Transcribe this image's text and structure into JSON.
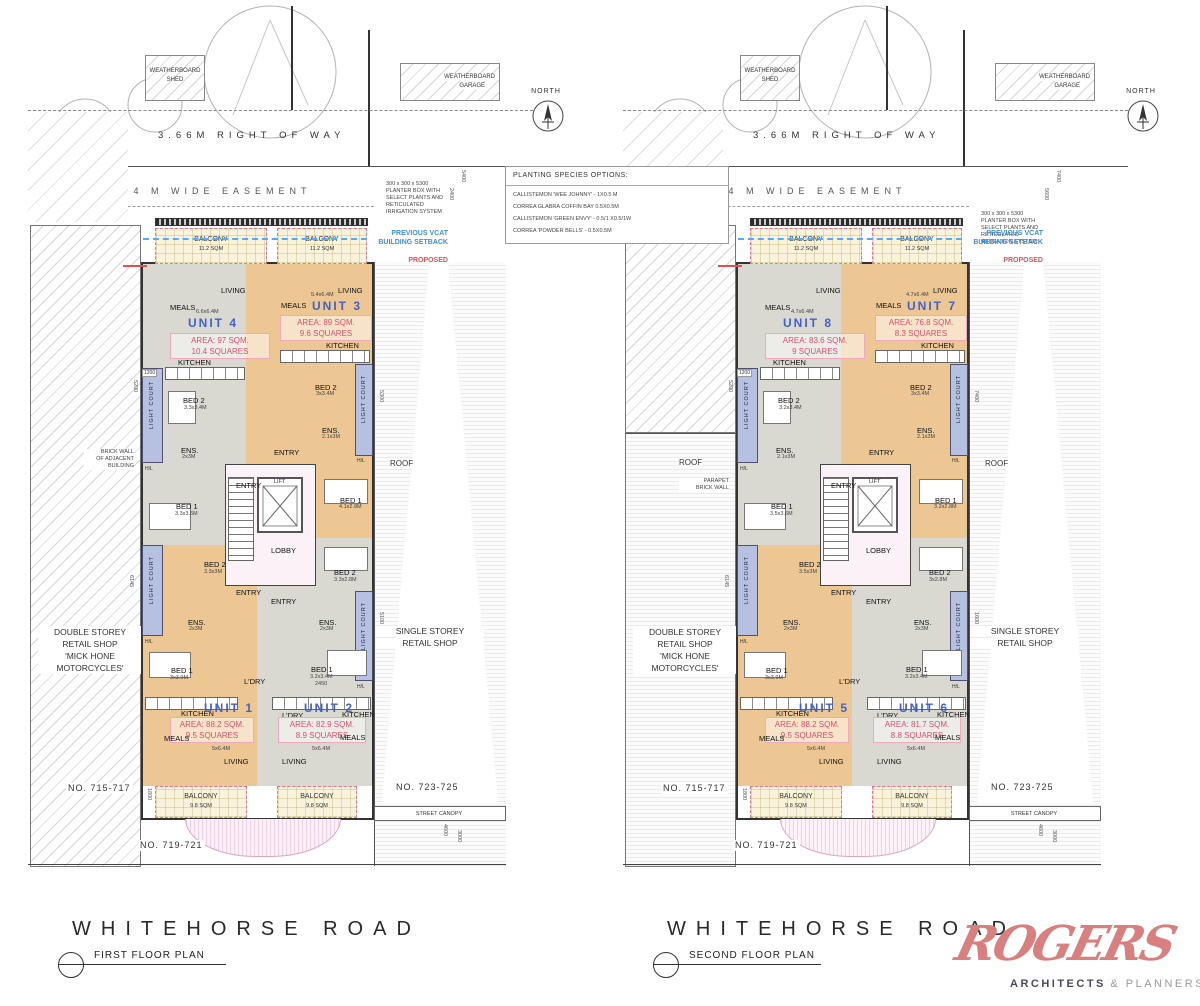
{
  "shared": {
    "shed_line1": "WEATHERBOARD",
    "shed_line2": "SHED",
    "garage_line1": "WEATHERBOARD",
    "garage_line2": "GARAGE",
    "right_of_way": "3.66M RIGHT OF WAY",
    "easement": "2.4 M WIDE EASEMENT",
    "north": "NORTH",
    "planter_note": [
      "300 x 300 x 5300",
      "PLANTER BOX WITH",
      "SELECT PLANTS AND",
      "RETICULATED",
      "IRRIGATION SYSTEM"
    ],
    "vcat_line1": "PREVIOUS VCAT",
    "vcat_line2": "BUILDING SETBACK",
    "proposed_line1": "PROPOSED",
    "proposed_line2": "BUILDING SETBACK",
    "light_court": "LIGHT COURT",
    "hl": "H/L",
    "lobby": "LOBBY",
    "lift": "LIFT",
    "entry": "ENTRY",
    "roof": "ROOF",
    "balcony": "BALCONY",
    "balcony_top_sqm": "11.2 SQM",
    "balcony_bot_sqm": "9.8 SQM",
    "retail_left": [
      "DOUBLE STOREY",
      "RETAIL SHOP",
      "'MICK HONE",
      "MOTORCYCLES'"
    ],
    "retail_right1": "SINGLE STOREY",
    "retail_right2": "RETAIL SHOP",
    "no_left": "NO. 715-717",
    "no_mid": "NO. 719-721",
    "no_right": "NO. 723-725",
    "street_canopy": "STREET CANOPY",
    "road": "WHITEHORSE ROAD"
  },
  "planting_box": {
    "title": "PLANTING SPECIES OPTIONS:",
    "species": [
      "CALLISTEMON 'WEE JOHNNY' - 1X0.5 M",
      "CORREA GLABRA COFFIN BAY 0.5X0.5M",
      "CALLISTEMON 'GREEN ENVY' - 0.5/1 X0.5/1W",
      "CORREA 'POWDER BELLS' - 0.5X0.5M"
    ]
  },
  "logo": {
    "name": "ROGERS",
    "sub_bold": "ARCHITECTS",
    "sub_light": "& PLANNERS",
    "color": "#d88080"
  },
  "plans": [
    {
      "title": "FIRST FLOOR PLAN",
      "side_note": [
        "BRICK WALL",
        "OF ADJACENT",
        "BUILDING"
      ],
      "units": {
        "a": {
          "name": "UNIT 4",
          "area": "AREA: 97 SQM.",
          "squares": "10.4 SQUARES",
          "dim": "6.6x6.4M",
          "living": "LIVING",
          "meals": "MEALS",
          "kitchen": "KITCHEN",
          "bed1": "BED 1",
          "bed1_dim": "3.3x3.6M",
          "bed2": "BED 2",
          "bed2_dim": "3.3x3.4M",
          "ens": "ENS.",
          "ens_dim": "2x3M"
        },
        "b": {
          "name": "UNIT 3",
          "area": "AREA: 89 SQM.",
          "squares": "9.6 SQUARES",
          "dim": "5.4x6.4M",
          "living": "LIVING",
          "meals": "MEALS",
          "kitchen": "KITCHEN",
          "bed1": "BED 1",
          "bed1_dim": "4.1x2.8M",
          "bed2": "BED 2",
          "bed2_dim": "3x3.4M",
          "ens": "ENS.",
          "ens_dim": "2.1x3M"
        },
        "c": {
          "name": "UNIT 1",
          "area": "AREA: 88.2 SQM.",
          "squares": "9.5 SQUARES",
          "dim": "5x6.4M",
          "living": "LIVING",
          "meals": "MEALS",
          "kitchen": "KITCHEN",
          "ldry": "L'DRY",
          "bed1": "BED 1",
          "bed1_dim": "3x3.9M",
          "bed2": "BED 2",
          "bed2_dim": "3.3x3M",
          "ens": "ENS.",
          "ens_dim": "2x3M"
        },
        "d": {
          "name": "UNIT 2",
          "area": "AREA: 82.9 SQM.",
          "squares": "8.9 SQUARES",
          "dim": "5x6.4M",
          "living": "LIVING",
          "meals": "MEALS",
          "kitchen": "KITCHEN",
          "ldry": "L'DRY",
          "bed1": "BED 1",
          "bed1_dim": "3.2x3.4M",
          "bed1_extra": "2450",
          "bed2": "BED 2",
          "bed2_dim": "3.3x2.8M",
          "ens": "ENS.",
          "ens_dim": "2x3M"
        }
      },
      "dims": {
        "d0": "5400",
        "d1": "2400",
        "d2": "5200",
        "d3": "6145",
        "d4": "5300",
        "d5": "5100",
        "d6": "1800",
        "d7": "4600",
        "d8": "3000",
        "d9": "1200"
      }
    },
    {
      "title": "SECOND FLOOR PLAN",
      "side_note": [
        "PARAPET",
        "BRICK WALL",
        ""
      ],
      "roof_left": "ROOF",
      "units": {
        "a": {
          "name": "UNIT 8",
          "area": "AREA: 83.6 SQM.",
          "squares": "9 SQUARES",
          "dim": "4.7x6.4M",
          "living": "LIVING",
          "meals": "MEALS",
          "kitchen": "KITCHEN",
          "bed1": "BED 1",
          "bed1_dim": "3.5x3.6M",
          "bed2": "BED 2",
          "bed2_dim": "3.2x3.4M",
          "ens": "ENS.",
          "ens_dim": "2.1x3M"
        },
        "b": {
          "name": "UNIT 7",
          "area": "AREA: 76.8 SQM.",
          "squares": "8.3 SQUARES",
          "dim": "4.7x6.4M",
          "living": "LIVING",
          "meals": "MEALS",
          "kitchen": "KITCHEN",
          "bed1": "BED 1",
          "bed1_dim": "3.2x2.8M",
          "bed2": "BED 2",
          "bed2_dim": "3x3.4M",
          "ens": "ENS.",
          "ens_dim": "2.1x3M"
        },
        "c": {
          "name": "UNIT 5",
          "area": "AREA: 88.2 SQM.",
          "squares": "9.5 SQUARES",
          "dim": "5x6.4M",
          "living": "LIVING",
          "meals": "MEALS",
          "kitchen": "KITCHEN",
          "ldry": "L'DRY",
          "bed1": "BED 1",
          "bed1_dim": "3x3.9M",
          "bed2": "BED 2",
          "bed2_dim": "3.5x3M",
          "ens": "ENS.",
          "ens_dim": "2x3M"
        },
        "d": {
          "name": "UNIT 6",
          "area": "AREA: 81.7 SQM.",
          "squares": "8.8 SQUARES",
          "dim": "5x6.4M",
          "living": "LIVING",
          "meals": "MEALS",
          "kitchen": "KITCHEN",
          "ldry": "L'DRY",
          "bed1": "BED 1",
          "bed1_dim": "3.2x3.4M",
          "bed1_extra": "",
          "bed2": "BED 2",
          "bed2_dim": "3x2.8M",
          "ens": "ENS.",
          "ens_dim": "2x3M"
        }
      },
      "dims": {
        "d0": "7400",
        "d1": "5600",
        "d2": "5200",
        "d3": "6145",
        "d4": "7400",
        "d5": "1600",
        "d6": "1800",
        "d7": "4600",
        "d8": "3000",
        "d9": "1200"
      }
    }
  ]
}
